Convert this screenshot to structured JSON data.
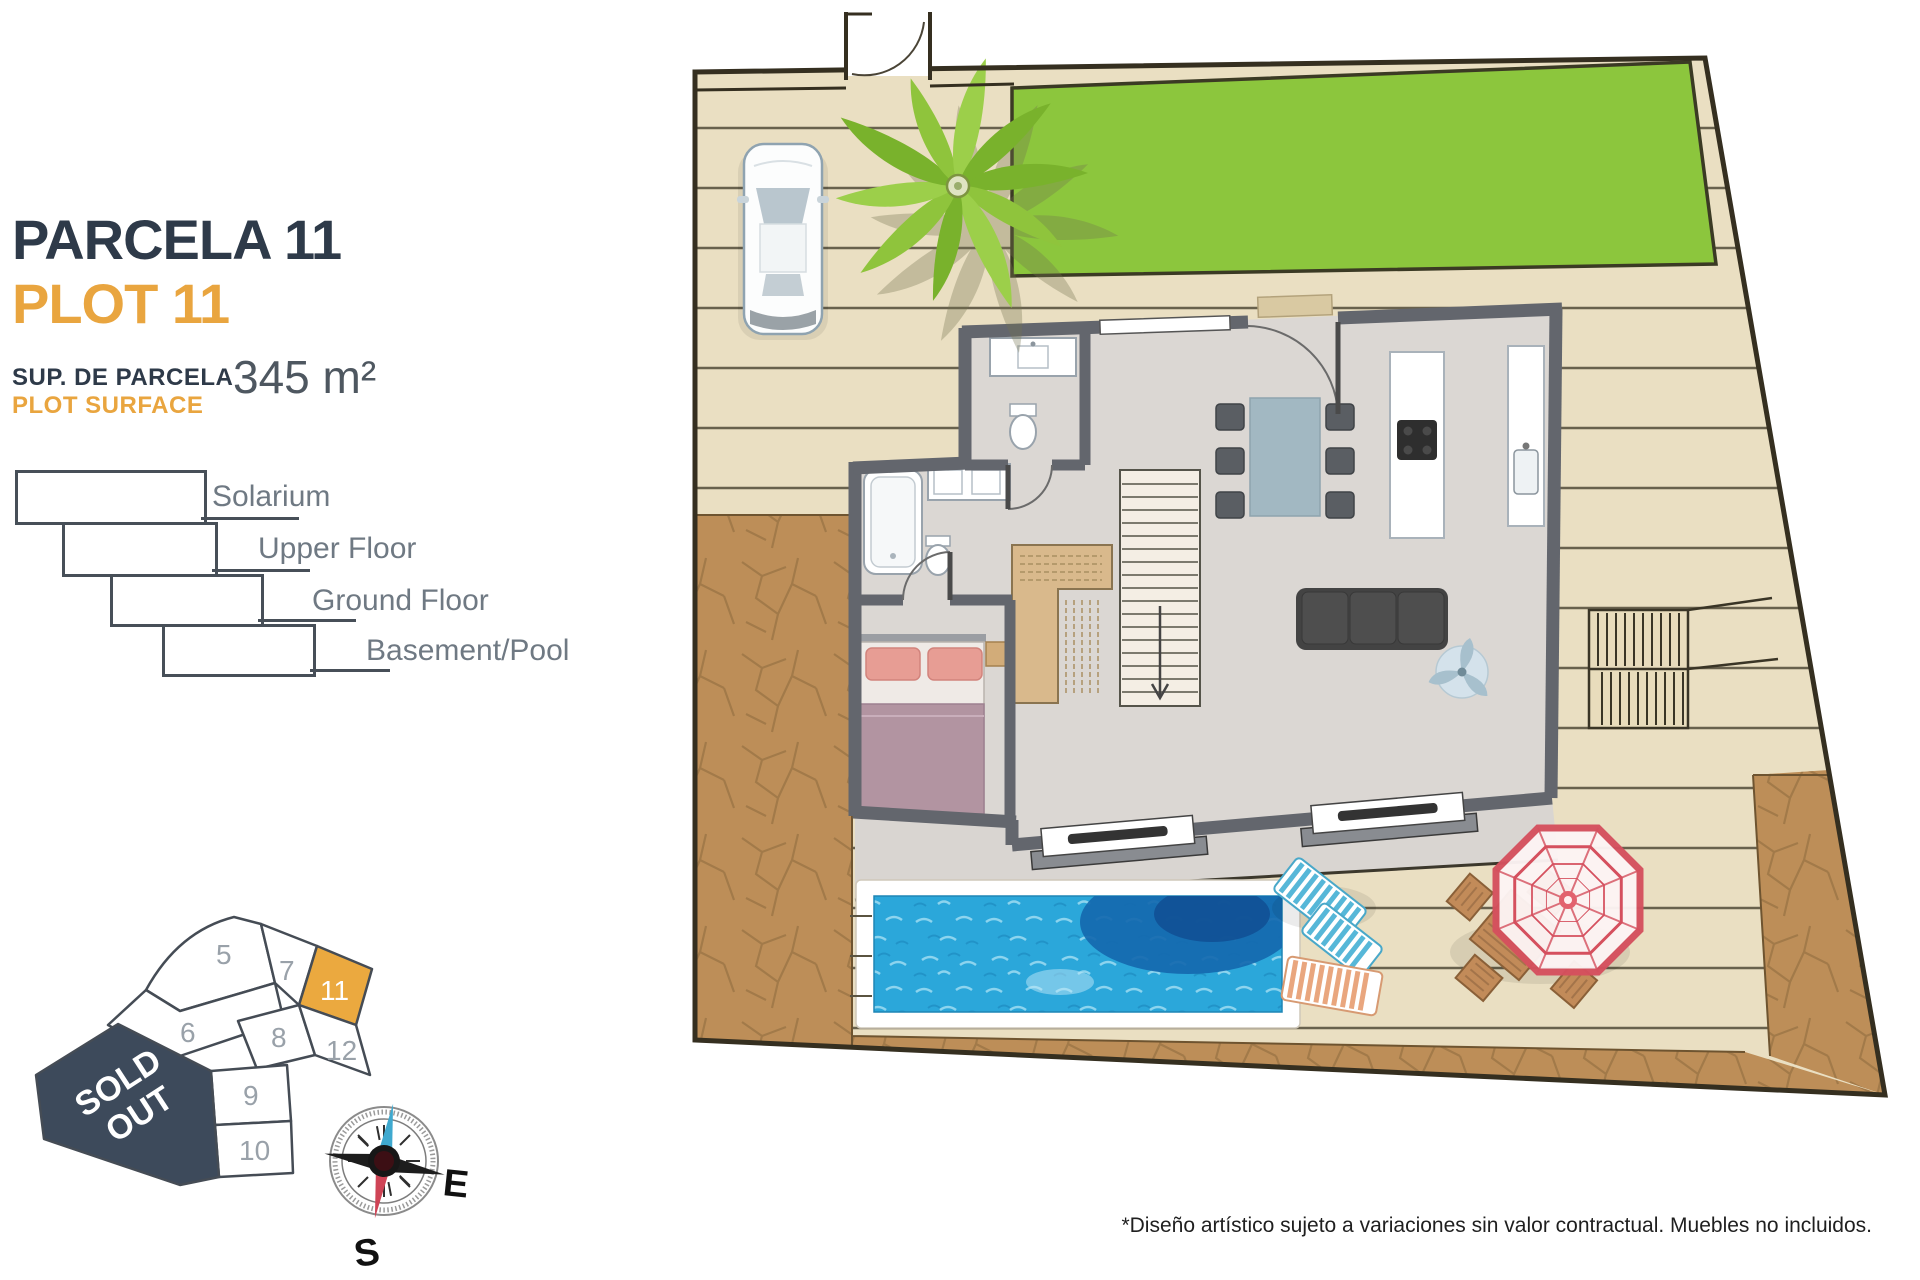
{
  "header": {
    "title": "PARCELA 11",
    "subtitle": "PLOT 11",
    "surface_label_primary": "SUP. DE PARCELA",
    "surface_label_secondary": "PLOT SURFACE",
    "surface_value": "345 m²"
  },
  "legend": {
    "items": [
      {
        "label": "Solarium"
      },
      {
        "label": "Upper Floor"
      },
      {
        "label": "Ground Floor"
      },
      {
        "label": "Basement/Pool"
      }
    ]
  },
  "plot_map": {
    "highlighted_plot": "11",
    "plots": [
      "5",
      "7",
      "11",
      "6",
      "8",
      "12",
      "9",
      "10"
    ],
    "sold_line1": "SOLD",
    "sold_line2": "OUT"
  },
  "compass": {
    "east": "E",
    "south": "S"
  },
  "footer": {
    "disclaimer": "*Diseño artístico sujeto a variaciones sin valor contractual. Muebles no incluidos."
  },
  "colors": {
    "navy": "#2e3a49",
    "accent_orange": "#e9a53f",
    "lawn_green": "#8cc63d",
    "deck_beige": "#eadfc2",
    "dirt_brown": "#bd8e58",
    "pool_blue": "#2ba7da",
    "sold_navy": "#3d4a5b",
    "umbrella_red": "#d5505e"
  }
}
